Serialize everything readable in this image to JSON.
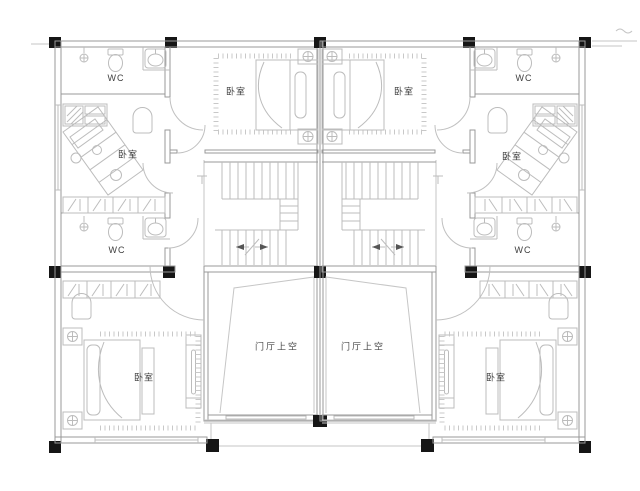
{
  "title": "duplex-second-floor-plan",
  "rooms": [
    {
      "id": "wc-top-left",
      "label": "WC"
    },
    {
      "id": "bedroom-mid-left",
      "label": "卧室"
    },
    {
      "id": "wc-bottom-left",
      "label": "WC"
    },
    {
      "id": "bedroom-top-left",
      "label": "卧室"
    },
    {
      "id": "bedroom-bottom-left",
      "label": "卧室"
    },
    {
      "id": "entry-void-left",
      "label": "门厅上空"
    },
    {
      "id": "wc-top-right",
      "label": "WC"
    },
    {
      "id": "bedroom-mid-right",
      "label": "卧室"
    },
    {
      "id": "wc-bottom-right",
      "label": "WC"
    },
    {
      "id": "bedroom-top-right",
      "label": "卧室"
    },
    {
      "id": "bedroom-bottom-right",
      "label": "卧室"
    },
    {
      "id": "entry-void-right",
      "label": "门厅上空"
    }
  ],
  "colors": {
    "background": "#ffffff",
    "wall_line": "#999999",
    "furniture_line": "#bcbcbc",
    "column_fill": "#161616",
    "label_text": "#404040"
  }
}
